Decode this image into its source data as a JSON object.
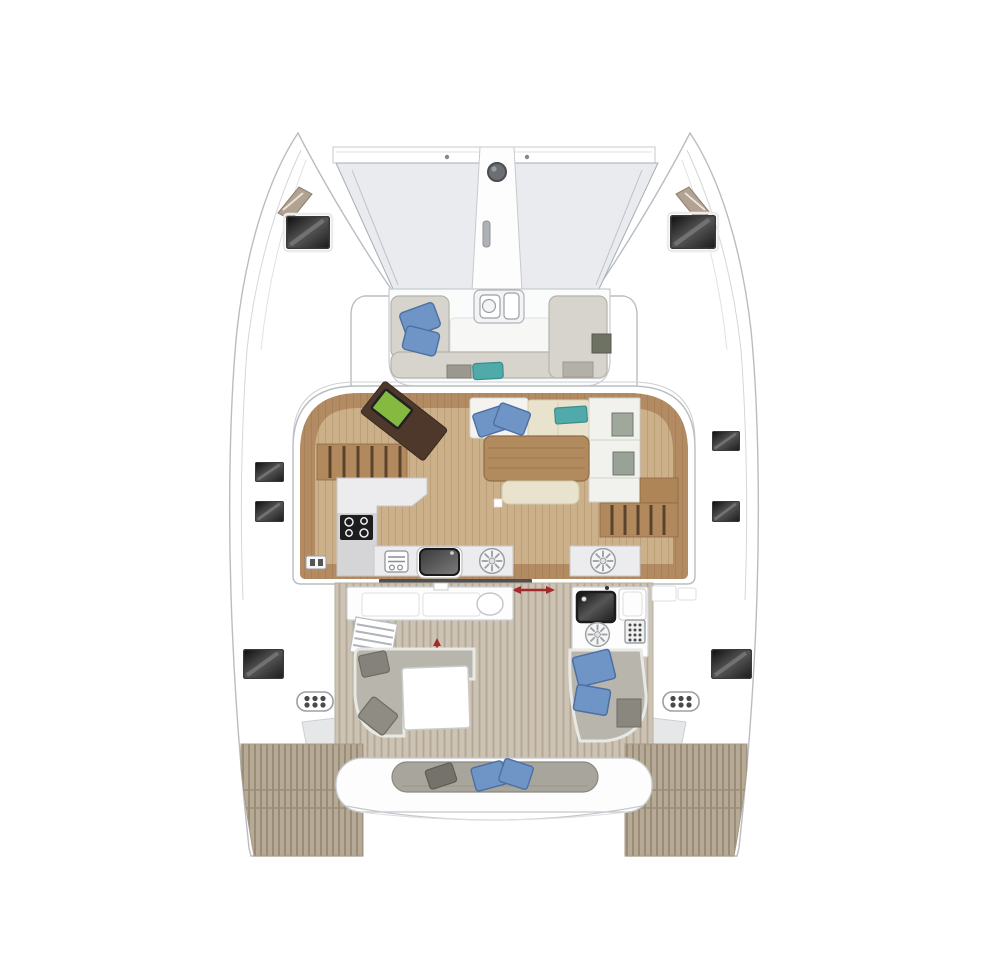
{
  "document": {
    "kind": "catamaran-sailboat-deck-plan",
    "view": "top-down",
    "orientation": "bow-at-top"
  },
  "colors": {
    "hull_fill": "#ffffff",
    "hull_line": "#b9bdc2",
    "trampoline": "#e9ebef",
    "trampoline_line": "#a7adb5",
    "wood_floor": "#cbb08a",
    "wood_rim": "#b28b62",
    "stairs_wood": "#b2895c",
    "stairs_line": "#5a432e",
    "shelf_wood": "#ad8557",
    "table_wood": "#b18a5e",
    "table_line": "#8f6d47",
    "desk_brown": "#4e382b",
    "laptop_green": "#85b93f",
    "sofa_white": "#f4f3ef",
    "sofa_cream": "#e9e2cc",
    "cushion_gray": "#d6d4cd",
    "cushion_gray_line": "#b5b3aa",
    "pillow_blue": "#6f94c6",
    "pillow_blue_line": "#4d6fa3",
    "cushion_teal": "#4faaa9",
    "cockpit_sofa": "#b7b5ac",
    "pillow_dark": "#84827a",
    "bench_gray": "#a8a69c",
    "counter_white": "#ececee",
    "counter_line": "#c9c9cc",
    "counter_gray": "#d5d5d7",
    "appliance_black": "#1d1d1f",
    "hatch_dark_1": "#0d0d0d",
    "hatch_dark_2": "#555555",
    "hatch_dark_3": "#1a1a1a",
    "sink_dark_1": "#3a3a3a",
    "sink_dark_2": "#7d7d7d",
    "teak_cockpit_base": "#ccc3b4",
    "teak_cockpit_stripe": "#b3a694",
    "teak_platform_base": "#b6aa97",
    "teak_platform_stripe": "#9a8d78",
    "window_tan": "#b2a291",
    "arrow_red": "#a32a2a",
    "pad_dot": "#4a4a4a",
    "windlass_gray": "#6b6e72",
    "door_track": "#4f4f4f"
  },
  "icons": {
    "windlass": "filled circle at bowsprit",
    "cooktop": "black square with 4 burner rings",
    "sink": "dark rounded basin with faucet dot",
    "vent_fan": "circle with radial spokes",
    "grill": "black glossy square",
    "control_panel": "dot-grid keypad",
    "step_pad": "rounded pad with 6 dots",
    "door_arrow": "red double-headed arrow"
  },
  "regions": {
    "bow": {
      "features": [
        "port-bow-hatch",
        "starboard-bow-hatch",
        "foredeck-windows",
        "trampoline",
        "bowsprit-channel",
        "windlass",
        "anchor-locker-slot",
        "forward-crossbeam"
      ]
    },
    "forward_cockpit": {
      "features": [
        "u-shaped-seating",
        "forward-hatch",
        "center-table",
        "side-table"
      ],
      "blue_pillows": 2,
      "teal_cushions": 1
    },
    "salon": {
      "features": [
        "port-companionway-stairs",
        "nav-desk",
        "laptop",
        "l-shaped-galley-counter",
        "cooktop",
        "aft-galley-counters",
        "sink",
        "vent-fans",
        "locker-icon",
        "dinette-sofa",
        "dinette-table",
        "dinette-bench",
        "cabinet-column",
        "starboard-companionway-stairs",
        "sliding-door-track"
      ],
      "blue_pillows": 2,
      "teal_cushions": 1,
      "cooktop_burners": 4,
      "vent_fans": 2
    },
    "cockpit": {
      "features": [
        "wet-bar-counter",
        "oval-sink",
        "port-steps",
        "port-l-sofa",
        "white-table",
        "outdoor-galley-module",
        "grill",
        "burner",
        "control-panel",
        "starboard-chaise",
        "door-arrows"
      ],
      "blue_pillows": 2,
      "gray_pillows": 2
    },
    "stern": {
      "features": [
        "aft-bench",
        "swim-platform-port",
        "swim-platform-starboard",
        "transom-steps"
      ],
      "blue_pillows": 2,
      "dark_pillows": 1
    },
    "side_decks": {
      "features": [
        "port-deck-hatches",
        "starboard-deck-hatches",
        "engine-step-pads"
      ],
      "port_hatches": 3,
      "starboard_hatches": 3,
      "step_pads": 2
    }
  }
}
